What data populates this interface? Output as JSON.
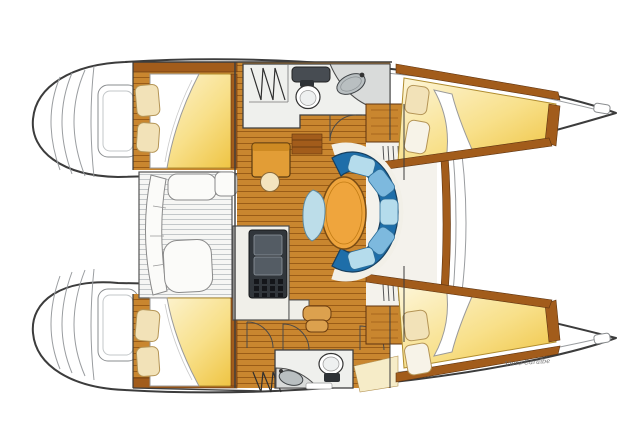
{
  "document": {
    "signature": "Vivre Caraïbe"
  },
  "vessel": {
    "type": "catamaran",
    "view": "top-down interior layout plan",
    "areas": [
      "swim-platform-port",
      "swim-platform-starboard",
      "aft-cabin-port",
      "aft-cabin-starboard",
      "forward-cabin-port",
      "forward-cabin-starboard",
      "head-port",
      "head-starboard",
      "salon-dinette",
      "galley",
      "nav-station",
      "cockpit",
      "foredeck"
    ],
    "furniture_counts": {
      "double_berths": 4,
      "toilets": 2,
      "sinks": 2,
      "dinette_tables": 1,
      "stools": 1
    }
  },
  "colors": {
    "wood": "#c9862f",
    "wood_line": "#9a5c17",
    "wood_dark": "#a25c1b",
    "wood_light": "#dca14e",
    "pillow": "#f2e2b8",
    "pillow_line": "#b49455",
    "settee_dark": "#1e6ea9",
    "settee_mid": "#7db9de",
    "settee_light": "#b5dcec",
    "table": "#efa53d",
    "table_line": "#7a4c13",
    "stool": "#bcdde9",
    "floor_white": "#eff0ed",
    "counter": "#d9dbda",
    "appliance": "#31363b",
    "deck": "#f6f6f4",
    "deck_line": "#c3c7c9",
    "cream": "#f4f2ec",
    "hull_line": "#3c3c3c",
    "thin_line": "#9a9da0",
    "signature": "#6a6a6a"
  }
}
